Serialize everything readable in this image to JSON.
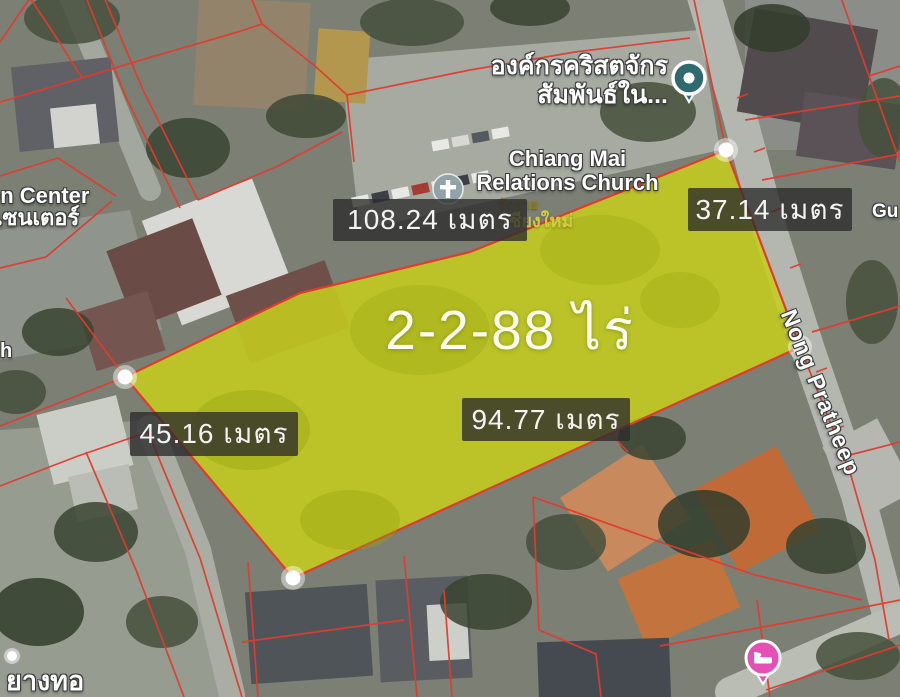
{
  "plot": {
    "area_label": "2-2-88 ไร่",
    "measurements": {
      "top": "108.24 เมตร",
      "right": "37.14 เมตร",
      "left": "45.16 เมตร",
      "bottom": "94.77 เมตร"
    }
  },
  "poi": {
    "organization": {
      "line1": "องค์กรคริสตจักร",
      "line2": "สัมพันธ์ใน..."
    },
    "church": {
      "line1": "Chiang Mai",
      "line2": "Relations Church"
    },
    "district": {
      "line1": "จักราย",
      "line2": "เชียงใหม่"
    },
    "center": {
      "line1": "en Center",
      "line2": "เซนเตอร์"
    },
    "partial_left": "h",
    "partial_right": "Gu",
    "partial_bottom": "ยางทอ"
  },
  "street": {
    "name": "Nong Pratheep"
  },
  "icons": {
    "organization_pin": "teal-circle-pin",
    "church_pin": "church-cross-pin",
    "lodging_pin": "pink-bed-pin"
  },
  "colors": {
    "plot_fill": "#c7cf1b",
    "parcel_line_red": "#e23b2e",
    "measure_label_bg": "#2c2c2c",
    "teal_pin": "#2e6a6e",
    "pink_pin": "#e64fb6",
    "church_pin": "#8fa3a8"
  }
}
